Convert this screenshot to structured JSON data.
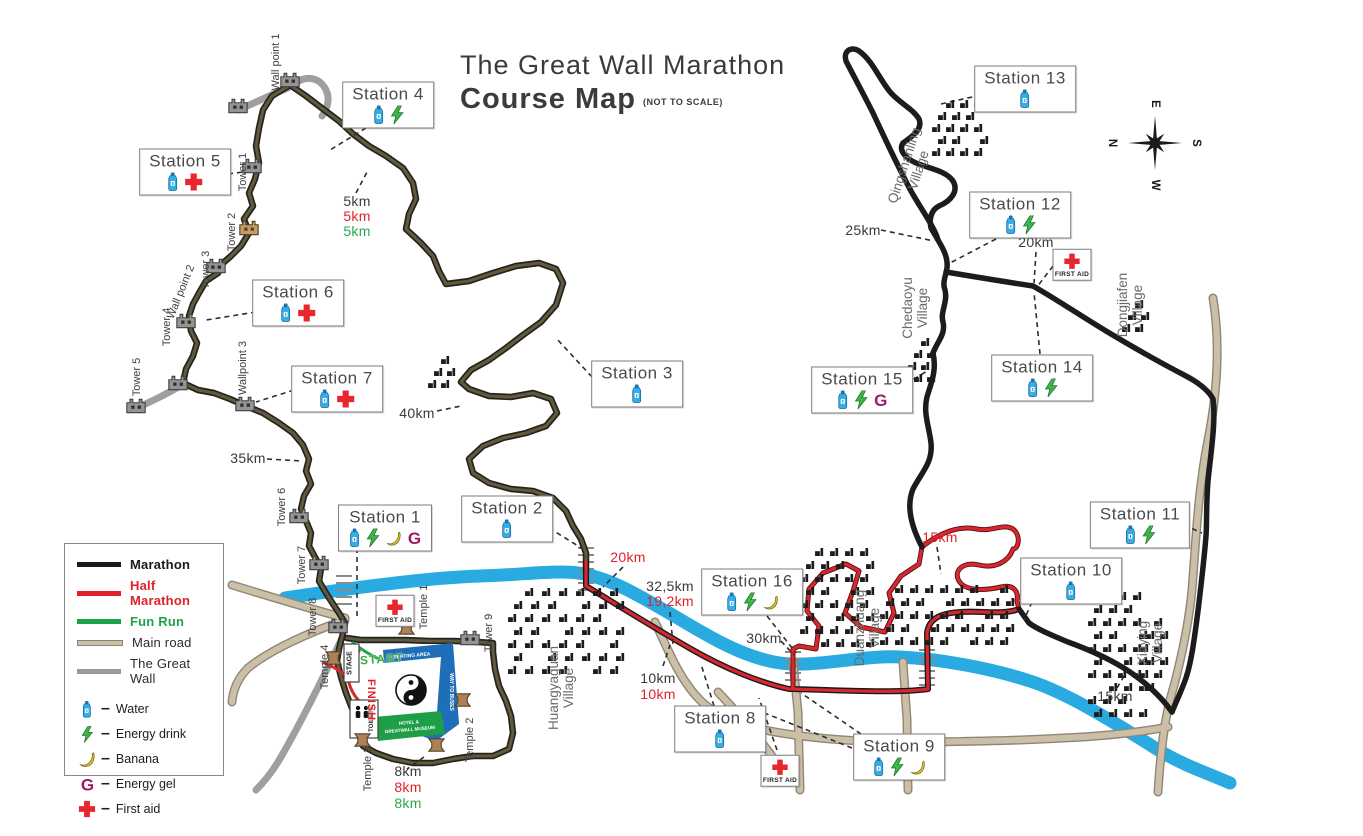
{
  "title": {
    "line1": "The Great Wall Marathon",
    "line2": "Course Map",
    "note": "(NOT TO SCALE)"
  },
  "legend": {
    "routes": [
      {
        "label": "Marathon",
        "color": "#1a1a1a",
        "text_color": "#1a1a1a",
        "bold": true
      },
      {
        "label": "Half Marathon",
        "color": "#e02128",
        "text_color": "#e02128",
        "bold": true
      },
      {
        "label": "Fun Run",
        "color": "#1fa24a",
        "text_color": "#1fa24a",
        "bold": true
      },
      {
        "label": "Main road",
        "color": "#cbbfa8",
        "text_color": "#2c2c2c",
        "bold": false
      },
      {
        "label": "The Great Wall",
        "color": "#9a9a9a",
        "text_color": "#2c2c2c",
        "bold": false
      }
    ],
    "services": [
      {
        "icon": "water-bottle-icon",
        "type": "water",
        "label": "Water"
      },
      {
        "icon": "energy-drink-icon",
        "type": "bolt",
        "label": "Energy drink"
      },
      {
        "icon": "banana-icon",
        "type": "banana",
        "label": "Banana"
      },
      {
        "icon": "energy-gel-icon",
        "type": "gel",
        "label": "Energy gel"
      },
      {
        "icon": "first-aid-icon",
        "type": "cross",
        "label": "First aid"
      }
    ]
  },
  "icons": {
    "gel_letter": "G"
  },
  "compass": {
    "top": "E",
    "right": "S",
    "bottom": "W",
    "left": "N"
  },
  "stations": [
    {
      "label": "Station 1",
      "icons": [
        "water",
        "bolt",
        "banana",
        "gel"
      ],
      "x": 385,
      "y": 528
    },
    {
      "label": "Station 2",
      "icons": [
        "water"
      ],
      "x": 507,
      "y": 519
    },
    {
      "label": "Station 3",
      "icons": [
        "water"
      ],
      "x": 637,
      "y": 384
    },
    {
      "label": "Station 4",
      "icons": [
        "water",
        "bolt"
      ],
      "x": 388,
      "y": 105
    },
    {
      "label": "Station 5",
      "icons": [
        "water",
        "cross"
      ],
      "x": 185,
      "y": 172
    },
    {
      "label": "Station 6",
      "icons": [
        "water",
        "cross"
      ],
      "x": 298,
      "y": 303
    },
    {
      "label": "Station 7",
      "icons": [
        "water",
        "cross"
      ],
      "x": 337,
      "y": 389
    },
    {
      "label": "Station 8",
      "icons": [
        "water"
      ],
      "x": 720,
      "y": 729
    },
    {
      "label": "Station 9",
      "icons": [
        "water",
        "bolt",
        "banana"
      ],
      "x": 899,
      "y": 757
    },
    {
      "label": "Station 10",
      "icons": [
        "water"
      ],
      "x": 1071,
      "y": 581
    },
    {
      "label": "Station 11",
      "icons": [
        "water",
        "bolt"
      ],
      "x": 1140,
      "y": 525
    },
    {
      "label": "Station 12",
      "icons": [
        "water",
        "bolt"
      ],
      "x": 1020,
      "y": 215
    },
    {
      "label": "Station 13",
      "icons": [
        "water"
      ],
      "x": 1025,
      "y": 89
    },
    {
      "label": "Station 14",
      "icons": [
        "water",
        "bolt"
      ],
      "x": 1042,
      "y": 378
    },
    {
      "label": "Station 15",
      "icons": [
        "water",
        "bolt",
        "gel"
      ],
      "x": 862,
      "y": 390
    },
    {
      "label": "Station 16",
      "icons": [
        "water",
        "bolt",
        "banana"
      ],
      "x": 752,
      "y": 592
    }
  ],
  "first_aid_posts": [
    {
      "label": "FIRST AID",
      "x": 1072,
      "y": 265
    },
    {
      "label": "FIRST AID",
      "x": 395,
      "y": 611
    },
    {
      "label": "FIRST AID",
      "x": 780,
      "y": 771
    }
  ],
  "distance_markers": [
    {
      "text": "5km",
      "color": "black",
      "x": 357,
      "y": 201
    },
    {
      "text": "5km",
      "color": "red",
      "x": 357,
      "y": 216
    },
    {
      "text": "5km",
      "color": "green",
      "x": 357,
      "y": 231
    },
    {
      "text": "8km",
      "color": "black",
      "x": 408,
      "y": 771
    },
    {
      "text": "8km",
      "color": "red",
      "x": 408,
      "y": 787
    },
    {
      "text": "8km",
      "color": "green",
      "x": 408,
      "y": 803
    },
    {
      "text": "35km",
      "color": "black",
      "x": 248,
      "y": 458
    },
    {
      "text": "40km",
      "color": "black",
      "x": 417,
      "y": 413
    },
    {
      "text": "20km",
      "color": "red",
      "x": 628,
      "y": 557
    },
    {
      "text": "32,5km",
      "color": "black",
      "x": 670,
      "y": 586
    },
    {
      "text": "19,2km",
      "color": "red",
      "x": 670,
      "y": 601
    },
    {
      "text": "10km",
      "color": "black",
      "x": 658,
      "y": 678
    },
    {
      "text": "10km",
      "color": "red",
      "x": 658,
      "y": 694
    },
    {
      "text": "30km",
      "color": "black",
      "x": 764,
      "y": 638
    },
    {
      "text": "25km",
      "color": "black",
      "x": 863,
      "y": 230
    },
    {
      "text": "20km",
      "color": "black",
      "x": 1036,
      "y": 242
    },
    {
      "text": "15km",
      "color": "red",
      "x": 940,
      "y": 537
    },
    {
      "text": "15km",
      "color": "black",
      "x": 1115,
      "y": 696
    }
  ],
  "villages": [
    {
      "line1": "Qingshanling",
      "line2": "Village",
      "x": 912,
      "y": 168,
      "rot": -72
    },
    {
      "line1": "Chedaoyu",
      "line2": "Village",
      "x": 916,
      "y": 308,
      "rot": -90
    },
    {
      "line1": "Dongjiafen",
      "line2": "Village",
      "x": 1131,
      "y": 305,
      "rot": -90
    },
    {
      "line1": "Duanzhuang",
      "line2": "Village",
      "x": 868,
      "y": 628,
      "rot": -90
    },
    {
      "line1": "Xiaying",
      "line2": "Village",
      "x": 1151,
      "y": 643,
      "rot": -90
    },
    {
      "line1": "Huangyaguan",
      "line2": "Village",
      "x": 562,
      "y": 688,
      "rot": -90
    }
  ],
  "landmarks": [
    {
      "text": "Wall point 1",
      "x": 276,
      "y": 62,
      "rot": -90
    },
    {
      "text": "Tower 1",
      "x": 243,
      "y": 172,
      "rot": -90
    },
    {
      "text": "Tower 2",
      "x": 232,
      "y": 232,
      "rot": -90
    },
    {
      "text": "Tower 3",
      "x": 206,
      "y": 270,
      "rot": -90
    },
    {
      "text": "Wall point 2",
      "x": 181,
      "y": 292,
      "rot": -68
    },
    {
      "text": "Tower 4",
      "x": 167,
      "y": 327,
      "rot": -90
    },
    {
      "text": "Tower 5",
      "x": 137,
      "y": 377,
      "rot": -90
    },
    {
      "text": "Wallpoint 3",
      "x": 243,
      "y": 368,
      "rot": -90
    },
    {
      "text": "Tower 6",
      "x": 282,
      "y": 507,
      "rot": -90
    },
    {
      "text": "Tower 7",
      "x": 302,
      "y": 565,
      "rot": -90
    },
    {
      "text": "Tower 8",
      "x": 313,
      "y": 617,
      "rot": -90
    },
    {
      "text": "Tower 9",
      "x": 489,
      "y": 633,
      "rot": -90
    },
    {
      "text": "Temple 1",
      "x": 424,
      "y": 607,
      "rot": -90
    },
    {
      "text": "Temple 4",
      "x": 325,
      "y": 667,
      "rot": -90
    },
    {
      "text": "Temple 3",
      "x": 368,
      "y": 769,
      "rot": -90
    },
    {
      "text": "Temple 2",
      "x": 470,
      "y": 740,
      "rot": -90
    }
  ],
  "start_area": {
    "start": "START",
    "finish": "FINISH",
    "stage": "STAGE",
    "toilets": "TOILETS",
    "seating_area": "SEATING AREA",
    "way_out": "WAY TO BUSES",
    "hotel_line1": "HOTEL &",
    "hotel_line2": "GREATWALL MUSEUM"
  }
}
